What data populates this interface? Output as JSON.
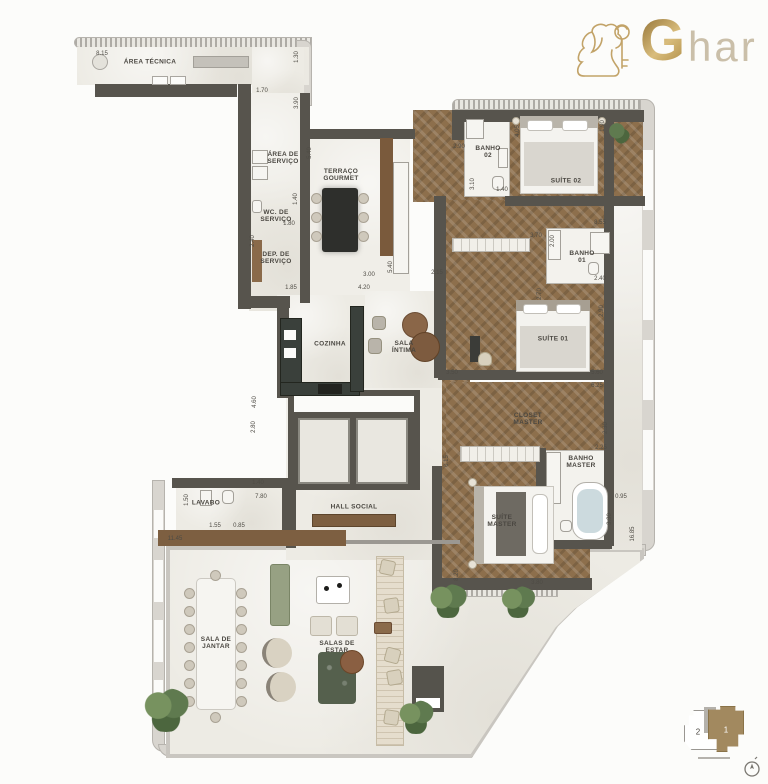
{
  "brand": {
    "g": "G",
    "rest": "har",
    "icon": "lion-key-icon",
    "gold": "#b5935a"
  },
  "colors": {
    "wall": "#57544d",
    "wood": "#8d6f4c",
    "marble": "#edebe4",
    "band": "#d8d5cf",
    "plant_green": "#6f8757",
    "keyplan_brown": "#a2895f",
    "accent_green_bench": "#97a183"
  },
  "keyplan": {
    "unit_left": "2",
    "unit_right": "1",
    "caption": ""
  },
  "room_labels": [
    {
      "label": "ÁREA TÉCNICA",
      "x": 150,
      "y": 62
    },
    {
      "label": "ÁREA DE\nSERVIÇO",
      "x": 283,
      "y": 158
    },
    {
      "label": "WC. DE\nSERVIÇO",
      "x": 276,
      "y": 216
    },
    {
      "label": "DEP. DE\nSERVIÇO",
      "x": 276,
      "y": 258
    },
    {
      "label": "TERRAÇO\nGOURMET",
      "x": 341,
      "y": 175
    },
    {
      "label": "BANHO\n02",
      "x": 488,
      "y": 152
    },
    {
      "label": "SUÍTE 02",
      "x": 566,
      "y": 181
    },
    {
      "label": "BANHO\n01",
      "x": 582,
      "y": 257
    },
    {
      "label": "SUÍTE 01",
      "x": 553,
      "y": 339
    },
    {
      "label": "COZINHA",
      "x": 330,
      "y": 344
    },
    {
      "label": "SALA\nÍNTIMA",
      "x": 404,
      "y": 347
    },
    {
      "label": "CLOSET\nMASTER",
      "x": 528,
      "y": 419
    },
    {
      "label": "BANHO\nMASTER",
      "x": 581,
      "y": 462
    },
    {
      "label": "SUÍTE\nMASTER",
      "x": 502,
      "y": 521
    },
    {
      "label": "HALL SOCIAL",
      "x": 354,
      "y": 507
    },
    {
      "label": "LAVABO",
      "x": 206,
      "y": 503
    },
    {
      "label": "SALA DE\nJANTAR",
      "x": 216,
      "y": 643
    },
    {
      "label": "SALAS DE\nESTAR",
      "x": 337,
      "y": 647
    }
  ],
  "dimension_labels": [
    {
      "t": "8.15",
      "x": 102,
      "y": 54,
      "v": false
    },
    {
      "t": "1.30",
      "x": 297,
      "y": 57,
      "v": true
    },
    {
      "t": "1.70",
      "x": 262,
      "y": 91,
      "v": false
    },
    {
      "t": "3.90",
      "x": 297,
      "y": 103,
      "v": true
    },
    {
      "t": "5.40",
      "x": 310,
      "y": 153,
      "v": true
    },
    {
      "t": "1.40",
      "x": 296,
      "y": 199,
      "v": true
    },
    {
      "t": "1.80",
      "x": 289,
      "y": 224,
      "v": false
    },
    {
      "t": "2.40",
      "x": 253,
      "y": 241,
      "v": true
    },
    {
      "t": "1.85",
      "x": 291,
      "y": 288,
      "v": false
    },
    {
      "t": "2.90",
      "x": 459,
      "y": 147,
      "v": false
    },
    {
      "t": "4.05",
      "x": 518,
      "y": 131,
      "v": true
    },
    {
      "t": "1.90",
      "x": 603,
      "y": 126,
      "v": true
    },
    {
      "t": "3.10",
      "x": 473,
      "y": 184,
      "v": true
    },
    {
      "t": "1.40",
      "x": 502,
      "y": 190,
      "v": false
    },
    {
      "t": "5.40",
      "x": 391,
      "y": 267,
      "v": true
    },
    {
      "t": "3.00",
      "x": 369,
      "y": 275,
      "v": false
    },
    {
      "t": "4.20",
      "x": 364,
      "y": 288,
      "v": false
    },
    {
      "t": "2.15",
      "x": 437,
      "y": 273,
      "v": false
    },
    {
      "t": "3.70",
      "x": 536,
      "y": 236,
      "v": false
    },
    {
      "t": "2.00",
      "x": 553,
      "y": 241,
      "v": true
    },
    {
      "t": "2.40",
      "x": 600,
      "y": 279,
      "v": false
    },
    {
      "t": "8.55",
      "x": 600,
      "y": 223,
      "v": false
    },
    {
      "t": "2.70",
      "x": 540,
      "y": 294,
      "v": true
    },
    {
      "t": "2.90",
      "x": 602,
      "y": 311,
      "v": true
    },
    {
      "t": "3.50",
      "x": 452,
      "y": 373,
      "v": false
    },
    {
      "t": "5.60",
      "x": 597,
      "y": 373,
      "v": false
    },
    {
      "t": "6.25",
      "x": 597,
      "y": 386,
      "v": false
    },
    {
      "t": "2.30",
      "x": 606,
      "y": 428,
      "v": true
    },
    {
      "t": "2.25",
      "x": 601,
      "y": 448,
      "v": false
    },
    {
      "t": "0.95",
      "x": 621,
      "y": 497,
      "v": false
    },
    {
      "t": "3.30",
      "x": 610,
      "y": 519,
      "v": true
    },
    {
      "t": "16.85",
      "x": 633,
      "y": 534,
      "v": true
    },
    {
      "t": "0.15",
      "x": 447,
      "y": 461,
      "v": true
    },
    {
      "t": "8.20",
      "x": 457,
      "y": 575,
      "v": true
    },
    {
      "t": "3.80",
      "x": 537,
      "y": 583,
      "v": false
    },
    {
      "t": "4.60",
      "x": 255,
      "y": 402,
      "v": true
    },
    {
      "t": "2.80",
      "x": 254,
      "y": 427,
      "v": true
    },
    {
      "t": "1.40",
      "x": 258,
      "y": 483,
      "v": false
    },
    {
      "t": "7.80",
      "x": 261,
      "y": 497,
      "v": false
    },
    {
      "t": "1.50",
      "x": 187,
      "y": 500,
      "v": true
    },
    {
      "t": "1.55",
      "x": 215,
      "y": 526,
      "v": false
    },
    {
      "t": "0.85",
      "x": 239,
      "y": 526,
      "v": false
    },
    {
      "t": "11.45",
      "x": 175,
      "y": 539,
      "v": false
    }
  ]
}
